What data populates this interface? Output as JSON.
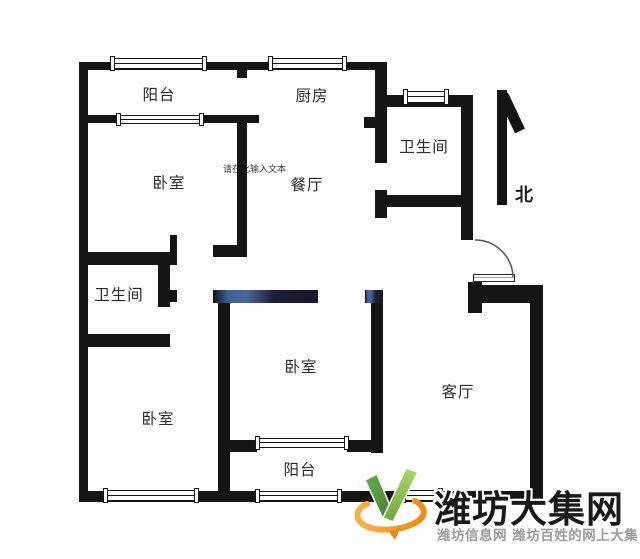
{
  "canvas": {
    "background": "#fdfdfd",
    "wall_color": "#141414"
  },
  "rooms": [
    {
      "id": "balcony-top",
      "label": "阳台",
      "cx": 159,
      "cy": 94
    },
    {
      "id": "kitchen",
      "label": "厨房",
      "cx": 312,
      "cy": 95
    },
    {
      "id": "bathroom-top",
      "label": "卫生间",
      "cx": 424,
      "cy": 146
    },
    {
      "id": "bedroom-top-left",
      "label": "卧室",
      "cx": 169,
      "cy": 182
    },
    {
      "id": "dining-room",
      "label": "餐厅",
      "cx": 307,
      "cy": 184
    },
    {
      "id": "bathroom-left",
      "label": "卫生间",
      "cx": 119,
      "cy": 294
    },
    {
      "id": "bedroom-middle",
      "label": "卧室",
      "cx": 301,
      "cy": 366
    },
    {
      "id": "bedroom-bottom-left",
      "label": "卧室",
      "cx": 158,
      "cy": 418
    },
    {
      "id": "living-room",
      "label": "客厅",
      "cx": 458,
      "cy": 391
    },
    {
      "id": "balcony-bottom",
      "label": "阳台",
      "cx": 300,
      "cy": 469
    }
  ],
  "compass": {
    "label": "北"
  },
  "placeholder_text": "请在此输入文本",
  "watermark": {
    "title": "潍坊大集网",
    "subtitle": "潍坊信息网 潍坊百姓的网上大集",
    "title_color": "#191919",
    "subtitle_color": "#9b9b9b",
    "logo_green_dark": "#4c8c35",
    "logo_green_light": "#8dc63f",
    "logo_orange": "#f39c1f"
  },
  "floorplan": {
    "walls": [
      {
        "x": 79,
        "y": 62,
        "w": 308,
        "h": 8
      },
      {
        "x": 79,
        "y": 62,
        "w": 9,
        "h": 440
      },
      {
        "x": 79,
        "y": 491,
        "w": 464,
        "h": 11
      },
      {
        "x": 530,
        "y": 285,
        "w": 13,
        "h": 217
      },
      {
        "x": 468,
        "y": 285,
        "w": 75,
        "h": 18
      },
      {
        "x": 468,
        "y": 282,
        "w": 14,
        "h": 31
      },
      {
        "x": 88,
        "y": 115,
        "w": 171,
        "h": 8
      },
      {
        "x": 237,
        "y": 70,
        "w": 10,
        "h": 8
      },
      {
        "x": 237,
        "y": 115,
        "w": 10,
        "h": 142
      },
      {
        "x": 213,
        "y": 245,
        "w": 34,
        "h": 12
      },
      {
        "x": 375,
        "y": 62,
        "w": 12,
        "h": 101
      },
      {
        "x": 364,
        "y": 117,
        "w": 11,
        "h": 11
      },
      {
        "x": 387,
        "y": 95,
        "w": 85,
        "h": 12
      },
      {
        "x": 461,
        "y": 95,
        "w": 12,
        "h": 145
      },
      {
        "x": 375,
        "y": 195,
        "w": 98,
        "h": 12
      },
      {
        "x": 375,
        "y": 190,
        "w": 12,
        "h": 28
      },
      {
        "x": 79,
        "y": 252,
        "w": 91,
        "h": 13
      },
      {
        "x": 170,
        "y": 235,
        "w": 7,
        "h": 30
      },
      {
        "x": 158,
        "y": 265,
        "w": 12,
        "h": 42
      },
      {
        "x": 170,
        "y": 290,
        "w": 7,
        "h": 12
      },
      {
        "x": 79,
        "y": 334,
        "w": 91,
        "h": 13
      },
      {
        "x": 213,
        "y": 290,
        "w": 105,
        "h": 13,
        "tint": true
      },
      {
        "x": 365,
        "y": 290,
        "w": 18,
        "h": 13,
        "tint": true
      },
      {
        "x": 218,
        "y": 303,
        "w": 12,
        "h": 188
      },
      {
        "x": 371,
        "y": 303,
        "w": 12,
        "h": 150
      },
      {
        "x": 230,
        "y": 440,
        "w": 27,
        "h": 12
      },
      {
        "x": 347,
        "y": 440,
        "w": 28,
        "h": 12
      }
    ],
    "windows": [
      {
        "x": 112,
        "y": 58,
        "w": 93,
        "h": 11
      },
      {
        "x": 118,
        "y": 115,
        "w": 84,
        "h": 9
      },
      {
        "x": 270,
        "y": 58,
        "w": 75,
        "h": 11
      },
      {
        "x": 405,
        "y": 91,
        "w": 42,
        "h": 12
      },
      {
        "x": 257,
        "y": 438,
        "w": 90,
        "h": 10
      },
      {
        "x": 105,
        "y": 490,
        "w": 92,
        "h": 11
      },
      {
        "x": 257,
        "y": 491,
        "w": 83,
        "h": 10
      },
      {
        "x": 403,
        "y": 490,
        "w": 38,
        "h": 11
      }
    ]
  }
}
